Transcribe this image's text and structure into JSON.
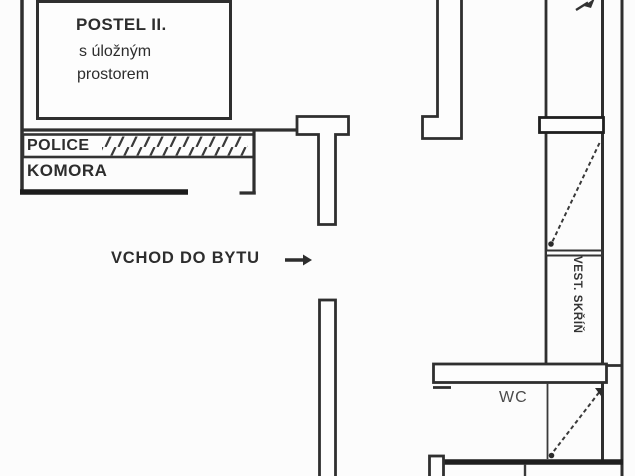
{
  "document": {
    "kind": "apartment floor plan (detail)"
  },
  "colors": {
    "background": "#fcfcfc",
    "wall_line": "#323232",
    "thick_wall": "#1e1e1e",
    "text": "#2d2d2d",
    "muted_text": "#4a4a4a"
  },
  "labels": {
    "bed": {
      "title": "POSTEL II.",
      "subtitle_line1": "s úložným",
      "subtitle_line2": "prostorem"
    },
    "shelf": "POLICE",
    "chamber": "KOMORA",
    "entrance": "VCHOD DO BYTU",
    "wc": "WC",
    "wardrobe": "VEST. SKŘÍŇ"
  },
  "icons": {
    "entrance_arrow": "right-arrow",
    "top_door_arrow": "up-right-arrow",
    "door_swings": "dashed-diagonal"
  }
}
